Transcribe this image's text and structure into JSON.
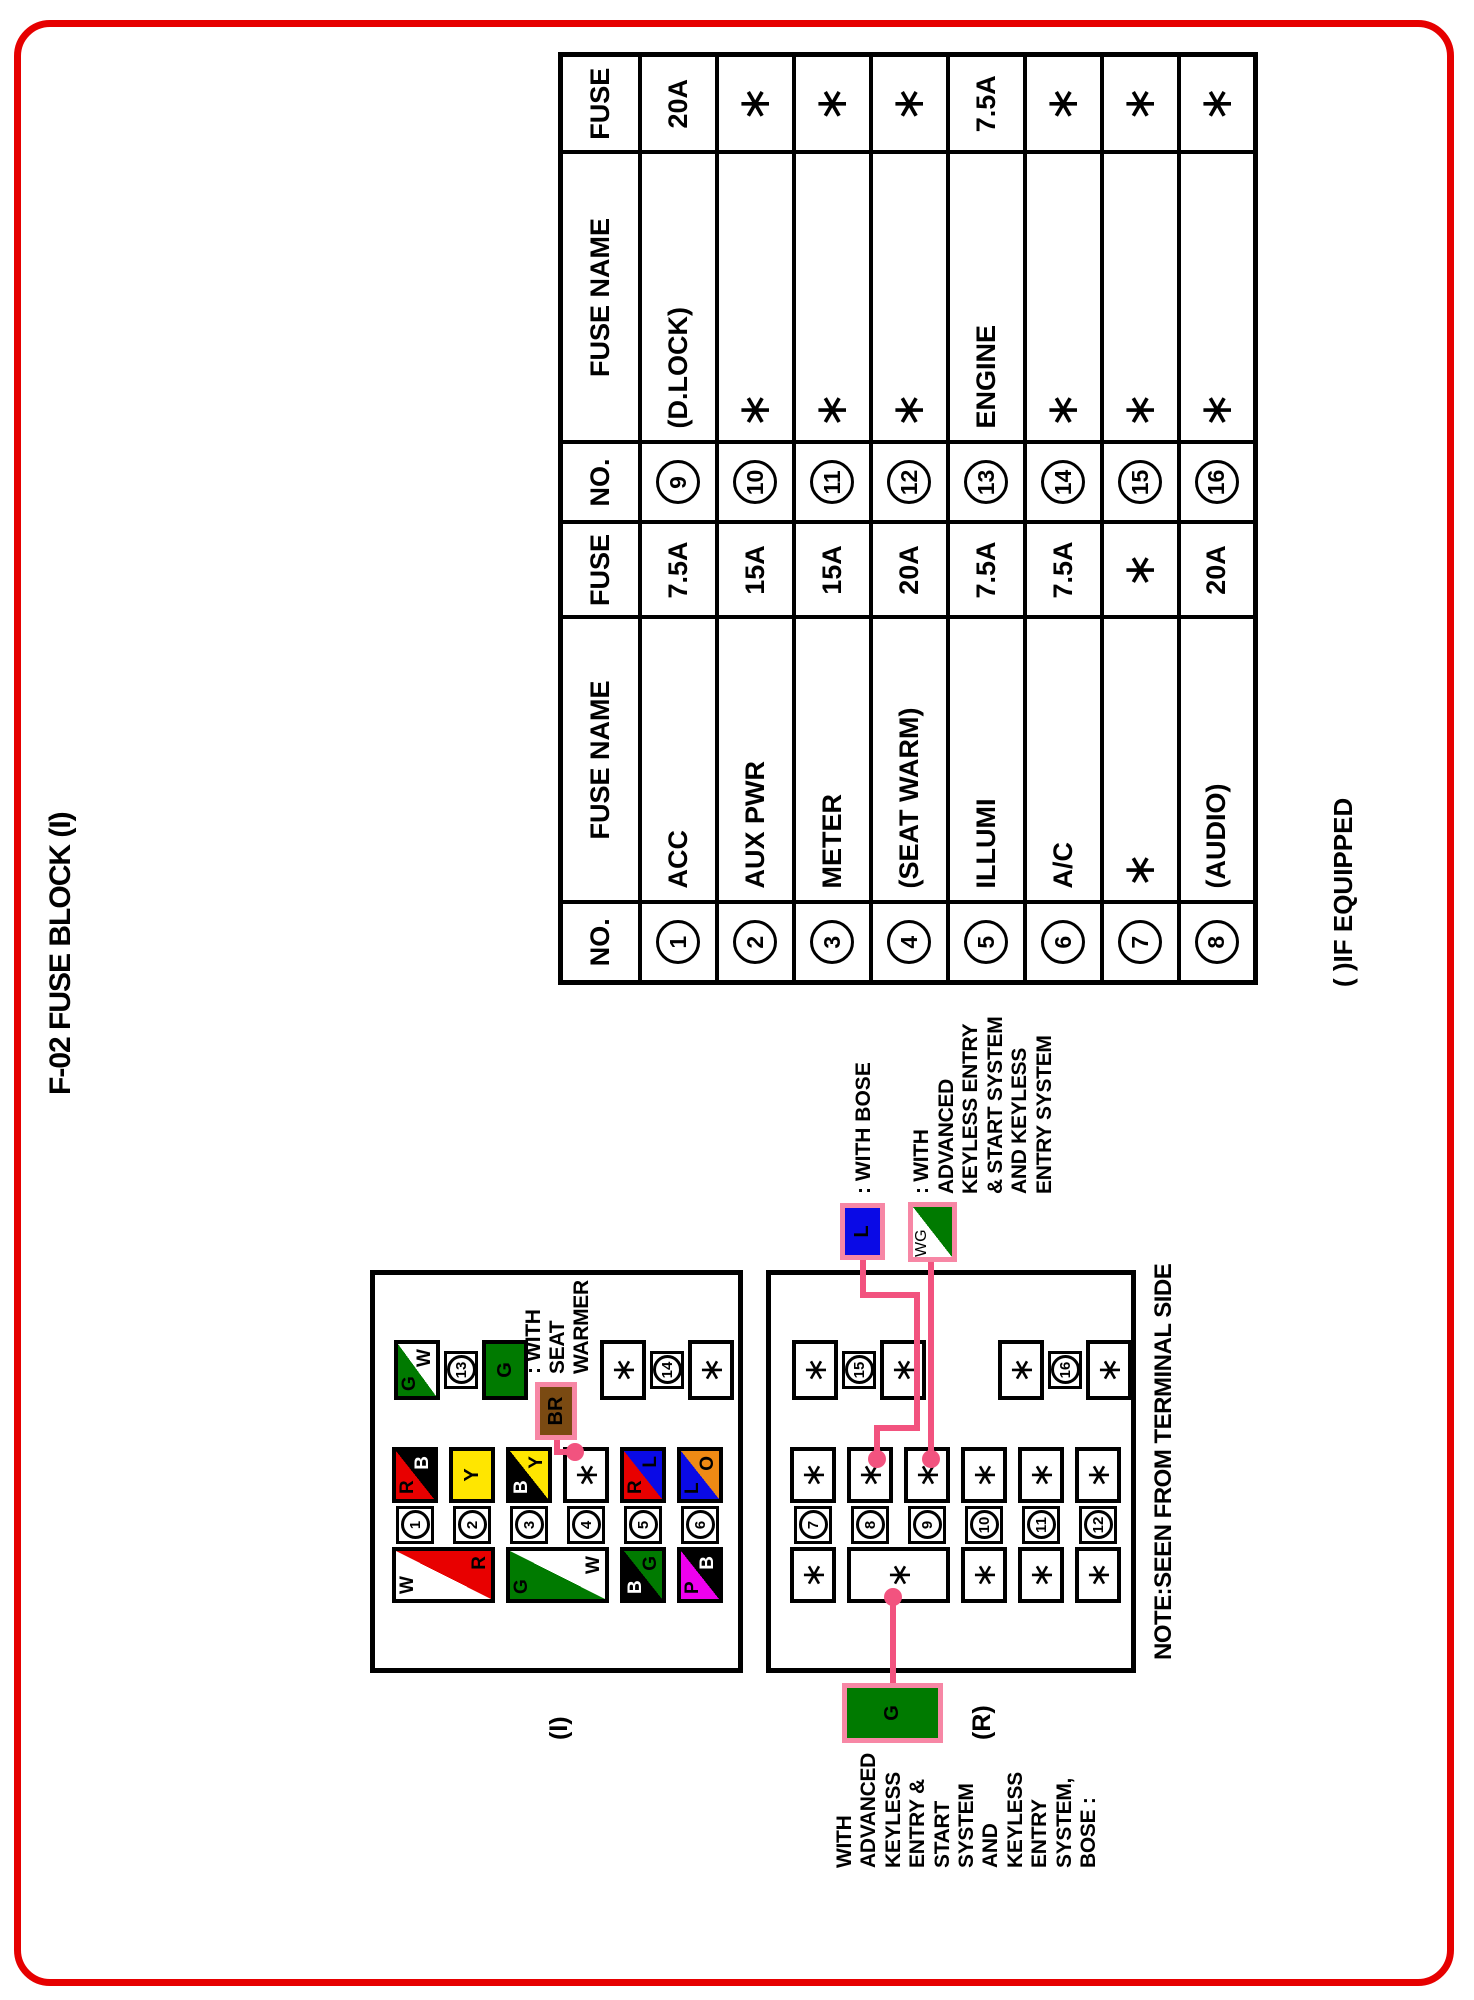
{
  "page": {
    "title": "F-02 FUSE BLOCK (I)",
    "footnote": "( )IF EQUIPPED",
    "note": "NOTE:SEEN FROM TERMINAL SIDE"
  },
  "colors": {
    "R": "#e80000",
    "B": "#000000",
    "Y": "#ffe600",
    "W": "#ffffff",
    "G": "#007a00",
    "L": "#0a0ae6",
    "O": "#ef8a14",
    "P": "#ee00ee",
    "BR": "#7a4a12",
    "pink_line": "#f2537f",
    "pink_border": "#f787a5",
    "page_border": "#e60000"
  },
  "table": {
    "headers": [
      "NO.",
      "FUSE NAME",
      "FUSE"
    ],
    "left_rows": [
      [
        "1",
        "ACC",
        "7.5A"
      ],
      [
        "2",
        "AUX PWR",
        "15A"
      ],
      [
        "3",
        "METER",
        "15A"
      ],
      [
        "4",
        "(SEAT WARM)",
        "20A"
      ],
      [
        "5",
        "ILLUMI",
        "7.5A"
      ],
      [
        "6",
        "A/C",
        "7.5A"
      ],
      [
        "7",
        "∗",
        "∗"
      ],
      [
        "8",
        "(AUDIO)",
        "20A"
      ]
    ],
    "right_rows": [
      [
        "9",
        "(D.LOCK)",
        "20A"
      ],
      [
        "10",
        "∗",
        "∗"
      ],
      [
        "11",
        "∗",
        "∗"
      ],
      [
        "12",
        "∗",
        "∗"
      ],
      [
        "13",
        "ENGINE",
        "7.5A"
      ],
      [
        "14",
        "∗",
        "∗"
      ],
      [
        "15",
        "∗",
        "∗"
      ],
      [
        "16",
        "∗",
        "∗"
      ]
    ]
  },
  "block_i": {
    "label": "(I)",
    "rows": [
      {
        "no": "1",
        "right": [
          "R",
          "B"
        ]
      },
      {
        "no": "2",
        "right": [
          "Y"
        ]
      },
      {
        "no": "3",
        "right": [
          "B",
          "Y"
        ]
      },
      {
        "no": "4",
        "right": [
          "∗"
        ]
      },
      {
        "no": "5",
        "right": [
          "R",
          "L"
        ]
      },
      {
        "no": "6",
        "right": [
          "L",
          "O"
        ]
      }
    ],
    "left_boxes": [
      {
        "row": 0,
        "span": 2,
        "colors": [
          "W",
          "R"
        ]
      },
      {
        "row": 2,
        "span": 2,
        "colors": [
          "G",
          "W"
        ]
      },
      {
        "row": 4,
        "span": 1,
        "colors": [
          "B",
          "G"
        ]
      },
      {
        "row": 5,
        "span": 1,
        "colors": [
          "P",
          "B"
        ]
      }
    ],
    "side_chains": [
      {
        "no": "13",
        "top": [
          "G",
          "W"
        ],
        "bottom": [
          "G"
        ]
      },
      {
        "no": "14",
        "top": [
          "∗"
        ],
        "bottom": [
          "∗"
        ]
      }
    ]
  },
  "block_r": {
    "label": "(R)",
    "rows": [
      {
        "no": "7",
        "right": [
          "∗"
        ]
      },
      {
        "no": "8",
        "right": [
          "∗"
        ]
      },
      {
        "no": "9",
        "right": [
          "∗"
        ]
      },
      {
        "no": "10",
        "right": [
          "∗"
        ]
      },
      {
        "no": "11",
        "right": [
          "∗"
        ]
      },
      {
        "no": "12",
        "right": [
          "∗"
        ]
      }
    ],
    "left_boxes": [
      {
        "row": 0,
        "span": 1,
        "colors": [
          "∗"
        ]
      },
      {
        "row": 1,
        "span": 2,
        "colors": [
          "∗"
        ]
      },
      {
        "row": 3,
        "span": 1,
        "colors": [
          "∗"
        ]
      },
      {
        "row": 4,
        "span": 1,
        "colors": [
          "∗"
        ]
      },
      {
        "row": 5,
        "span": 1,
        "colors": [
          "∗"
        ]
      }
    ],
    "side_chains": [
      {
        "no": "15",
        "top": [
          "∗"
        ],
        "bottom": [
          "∗"
        ]
      },
      {
        "no": "16",
        "top": [
          "∗"
        ],
        "bottom": [
          "∗"
        ]
      }
    ]
  },
  "callouts": {
    "seat_warmer": {
      "box_label": "BR",
      "lines": [
        ": WITH",
        "SEAT",
        "WARMER"
      ]
    },
    "bose": {
      "box_label": "L",
      "label": ": WITH BOSE"
    },
    "keyless": {
      "box_colors": [
        "W",
        "G"
      ],
      "lines": [
        ": WITH",
        "ADVANCED",
        "KEYLESS ENTRY",
        "& START SYSTEM",
        "AND KEYLESS",
        "ENTRY SYSTEM"
      ]
    },
    "g_block": {
      "box_label": "G",
      "lines": [
        "WITH",
        "ADVANCED",
        "KEYLESS",
        "ENTRY &",
        "START",
        "SYSTEM",
        "AND",
        "KEYLESS",
        "ENTRY",
        "SYSTEM,",
        "BOSE :"
      ]
    }
  }
}
